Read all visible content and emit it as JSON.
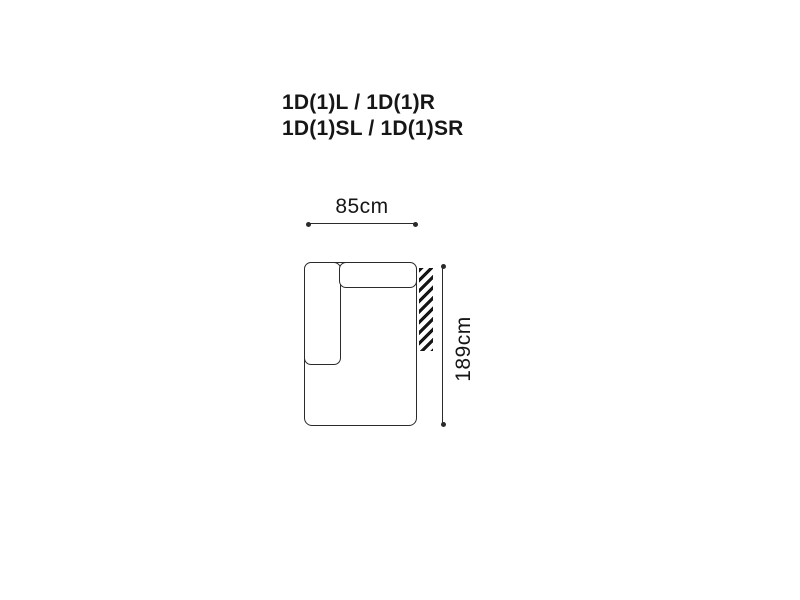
{
  "theme": {
    "bg-color": "#ffffff",
    "line-color": "#2b2b2b",
    "text-color": "#161616",
    "hatch-color": "#161616"
  },
  "title": {
    "line1": "1D(1)L / 1D(1)R",
    "line2": "1D(1)SL / 1D(1)SR"
  },
  "diagram": {
    "type": "sofa-module-top-view",
    "width_label": "85cm",
    "height_label": "189cm",
    "parts": {
      "outline": "seat-base",
      "armrest": "left-armrest",
      "backrest": "top-backrest",
      "hatch": "connection-side-marker"
    }
  }
}
